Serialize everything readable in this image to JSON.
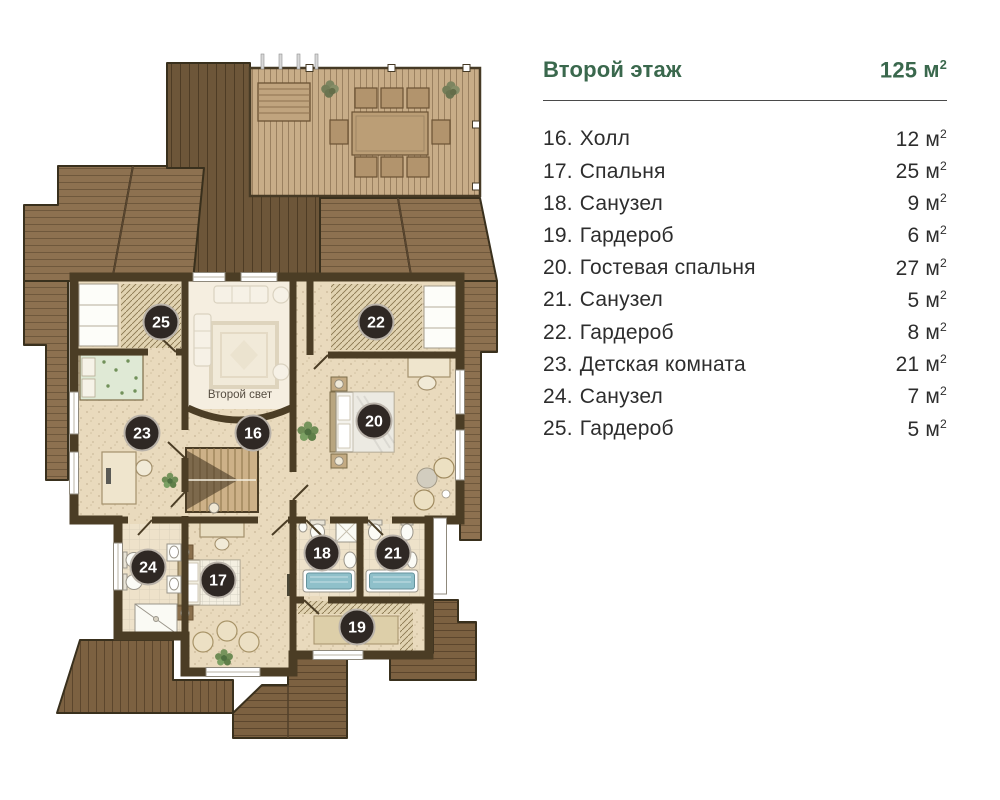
{
  "header": {
    "title": "Второй этаж",
    "total_area": "125"
  },
  "units": {
    "m": "м",
    "sup": "2"
  },
  "legend": {
    "rows": [
      {
        "num": "16.",
        "name": "Холл",
        "area": "12"
      },
      {
        "num": "17.",
        "name": "Спальня",
        "area": "25"
      },
      {
        "num": "18.",
        "name": "Санузел",
        "area": "9"
      },
      {
        "num": "19.",
        "name": "Гардероб",
        "area": "6"
      },
      {
        "num": "20.",
        "name": "Гостевая спальня",
        "area": "27"
      },
      {
        "num": "21.",
        "name": "Санузел",
        "area": "5"
      },
      {
        "num": "22.",
        "name": "Гардероб",
        "area": "8"
      },
      {
        "num": "23.",
        "name": "Детская комната",
        "area": "21"
      },
      {
        "num": "24.",
        "name": "Санузел",
        "area": "7"
      },
      {
        "num": "25.",
        "name": "Гардероб",
        "area": "5"
      }
    ]
  },
  "plan": {
    "void_label": "Второй свет",
    "badges": {
      "16": "16",
      "17": "17",
      "18": "18",
      "19": "19",
      "20": "20",
      "21": "21",
      "22": "22",
      "23": "23",
      "24": "24",
      "25": "25"
    }
  },
  "colors": {
    "accent_green": "#3a684d",
    "wall_brown": "#4b3d25",
    "roof_medium": "#8d7150",
    "roof_dark": "#6d5639",
    "deck_tan": "#c8ad88",
    "floor_beige": "#e9dabd",
    "badge_dark": "#2f2824",
    "bath_blue": "#8fc0ca"
  }
}
